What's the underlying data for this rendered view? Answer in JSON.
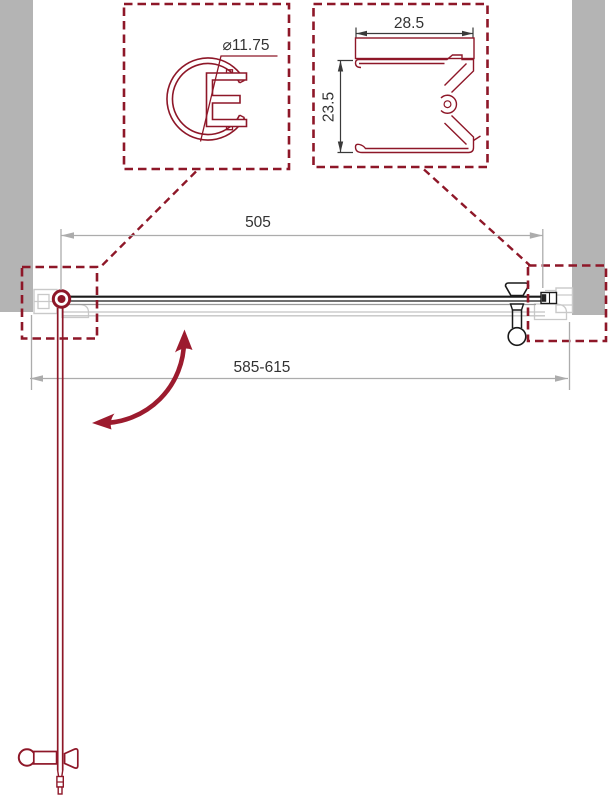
{
  "labels": {
    "hinge_profile_diameter": "⌀11.75",
    "wall_profile_width": "28.5",
    "wall_profile_height": "23.5",
    "glass_width": "505",
    "adjustment_range": "585-615"
  },
  "colors": {
    "accent_red": "#8E1728",
    "arc_red": "#9C1B2E",
    "wall_gray": "#B4B4B4",
    "dim_gray": "#ACACAC",
    "profile_gray": "#C9C9C9",
    "ink": "#333333",
    "door_black": "#1A1A1A"
  }
}
